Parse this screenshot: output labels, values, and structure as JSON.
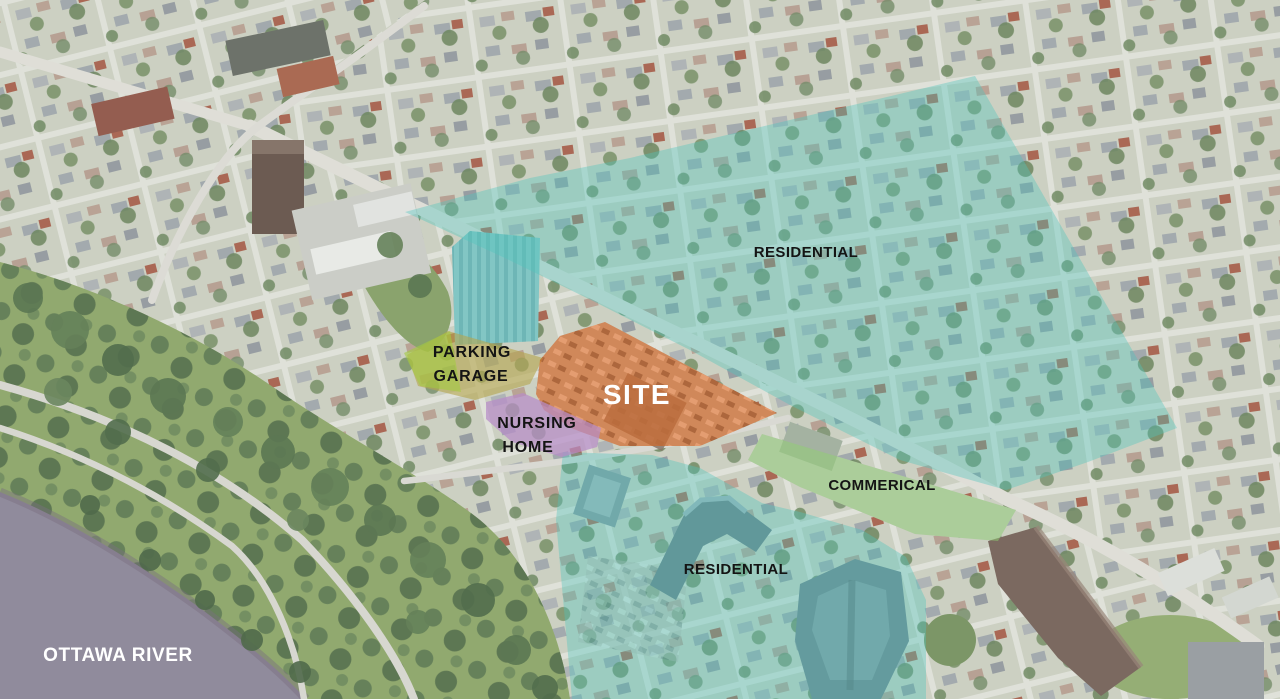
{
  "map": {
    "labels": {
      "residential_north": "RESIDENTIAL",
      "parking_garage_line1": "PARKING",
      "parking_garage_line2": "GARAGE",
      "site": "SITE",
      "nursing_home_line1": "NURSING",
      "nursing_home_line2": "HOME",
      "commercial": "COMMERICAL",
      "residential_south": "RESIDENTIAL",
      "water": "OTTAWA RIVER"
    },
    "zone_colors": {
      "residential": "#4fc4bc",
      "site": "#e0671f",
      "parking_garage": "#b5a74f",
      "parking_garage_accent": "#a4cc3f",
      "nursing_home": "#b78cc8",
      "commercial": "#8fd072",
      "water": "#868093"
    }
  }
}
